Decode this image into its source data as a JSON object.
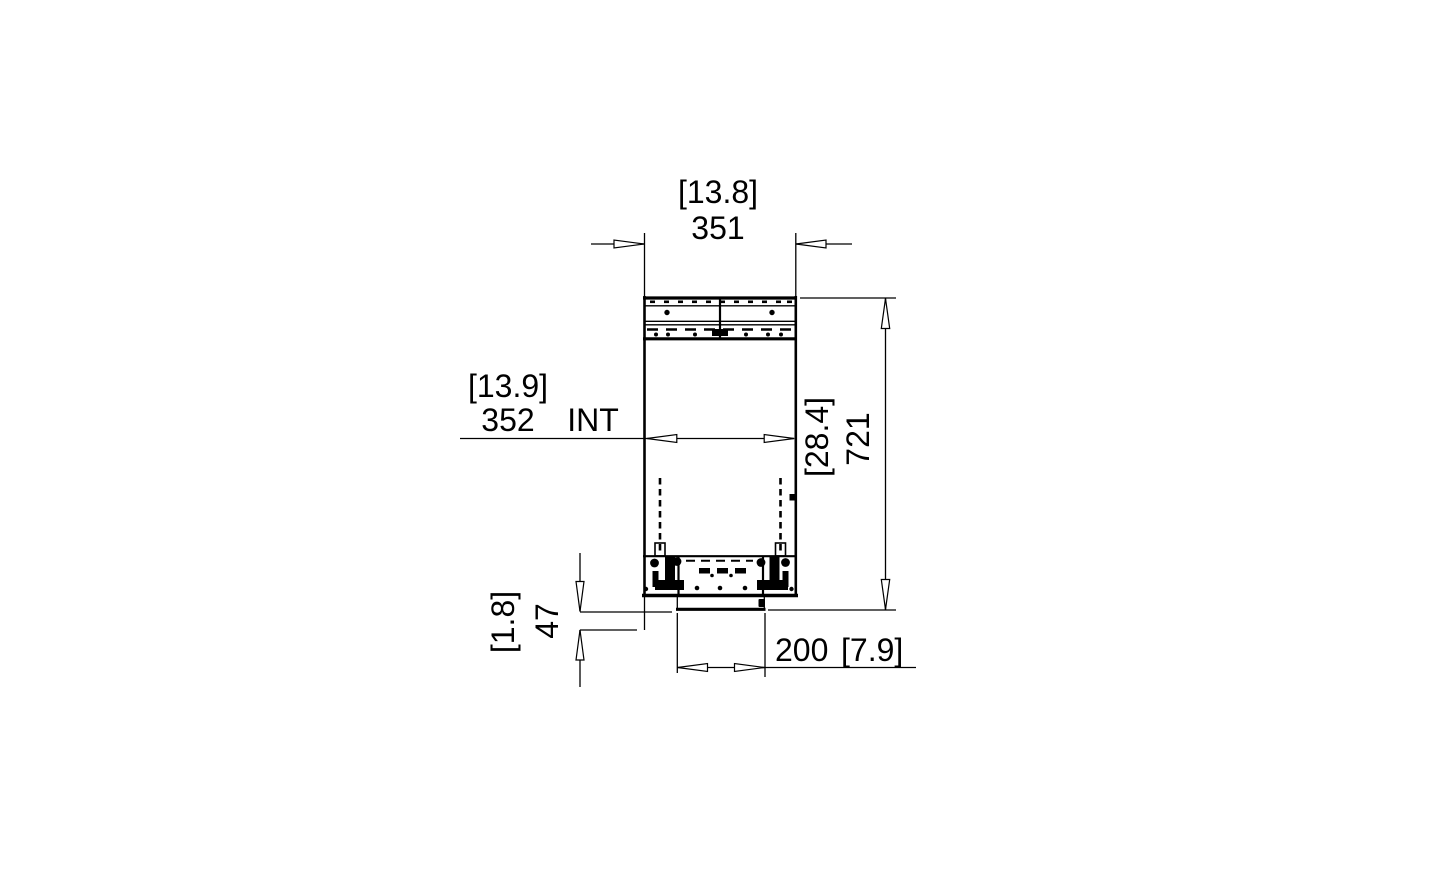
{
  "page": {
    "background": "#ffffff"
  },
  "drawing": {
    "kind": "front-section-technical-drawing",
    "line_color": "#000000",
    "units_format": "mm [inches]",
    "labels": {
      "top_width_in": "[13.8]",
      "top_width_mm": "351",
      "internal_width_in": "[13.9]",
      "internal_width_mm": "352",
      "internal_width_suffix": "INT",
      "overall_height_in": "[28.4]",
      "overall_height_mm": "721",
      "flange_height_in": "[1.8]",
      "flange_height_mm": "47",
      "bottom_width_mm": "200",
      "bottom_width_in": "[7.9]"
    }
  }
}
